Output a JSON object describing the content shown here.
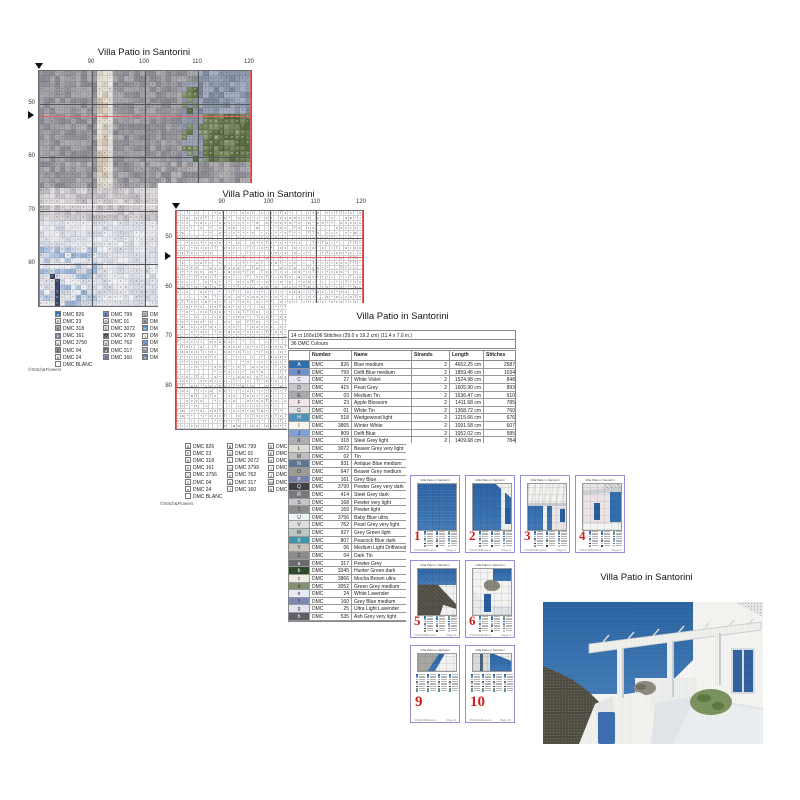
{
  "colors": {
    "accent_red": "#cc1f1f",
    "thumb_border": "#9191d9",
    "red_line": "#e06060",
    "sea": "#336fae"
  },
  "chart1": {
    "title": "Villa Patio in Santorini",
    "x_labels": [
      "90",
      "100",
      "110",
      "120"
    ],
    "y_labels": [
      "50",
      "60",
      "70",
      "80"
    ],
    "watermark": "©Stitch&Flowers",
    "legend": {
      "col1": [
        {
          "sym": "A",
          "num": "DMC 826",
          "color": "#2f6fad"
        },
        {
          "sym": "F",
          "num": "DMC 23",
          "color": "#f2e4ea"
        },
        {
          "sym": "K",
          "num": "DMC 318",
          "color": "#aeaeb2"
        },
        {
          "sym": "P",
          "num": "DMC 161",
          "color": "#7680a8"
        },
        {
          "sym": "U",
          "num": "DMC 3756",
          "color": "#eef5f9"
        },
        {
          "sym": "Z",
          "num": "DMC 04",
          "color": "#8b8b8b"
        },
        {
          "sym": "e",
          "num": "DMC 24",
          "color": "#e7e9f4"
        },
        {
          "sym": "·",
          "num": "DMC BLANC",
          "color": "#ffffff"
        }
      ],
      "col2": [
        {
          "sym": "B",
          "num": "DMC 799",
          "color": "#7291cc"
        },
        {
          "sym": "G",
          "num": "DMC 01",
          "color": "#e4e4e7"
        },
        {
          "sym": "L",
          "num": "DMC 3072",
          "color": "#dcdbd4"
        },
        {
          "sym": "Q",
          "num": "DMC 3799",
          "color": "#3f3f44"
        },
        {
          "sym": "V",
          "num": "DMC 762",
          "color": "#dfdfe2"
        },
        {
          "sym": "a",
          "num": "DMC 317",
          "color": "#69696e"
        },
        {
          "sym": "f",
          "num": "DMC 160",
          "color": "#7d89b4"
        }
      ],
      "col3": [
        {
          "sym": "D",
          "num": "DMC",
          "color": "#c6c7cb"
        },
        {
          "sym": "E",
          "num": "DMC",
          "color": "#a9a9ad"
        },
        {
          "sym": "H",
          "num": "DMC",
          "color": "#4f93ba"
        },
        {
          "sym": "I",
          "num": "DMC",
          "color": "#f8f6ef"
        },
        {
          "sym": "J",
          "num": "DMC",
          "color": "#7fa1d7"
        },
        {
          "sym": "M",
          "num": "DMC",
          "color": "#bfbfc2"
        },
        {
          "sym": "N",
          "num": "DMC",
          "color": "#5d7792"
        }
      ]
    }
  },
  "chart2": {
    "title": "Villa Patio in Santorini",
    "x_labels": [
      "90",
      "100",
      "110",
      "120"
    ],
    "y_labels": [
      "50",
      "60",
      "70",
      "80"
    ],
    "watermark": "©Stitch&Flowers"
  },
  "table": {
    "title": "Villa Patio in Santorini",
    "size_line": "14 ct 160x106 Stitches (29.0 x 19.2 cm) (11.4 x 7.6 in.)",
    "colors_line": "36 DMC Colours",
    "brand": "DMC",
    "headers": [
      "Number",
      "Name",
      "Strands",
      "Length",
      "Stitches"
    ],
    "rows": [
      {
        "sym": "A",
        "color": "#2f6fad",
        "code": "826",
        "name": "Blue medium",
        "strands": "2",
        "length": "4652.25 cm",
        "stitches": "2587"
      },
      {
        "sym": "B",
        "color": "#7291cc",
        "code": "799",
        "name": "Delft Blue medium",
        "strands": "2",
        "length": "1859.46 cm",
        "stitches": "1034"
      },
      {
        "sym": "C",
        "color": "#e8e8f2",
        "code": "27",
        "name": "White Violet",
        "strands": "2",
        "length": "1524.98 cm",
        "stitches": "848"
      },
      {
        "sym": "D",
        "color": "#c6c7cb",
        "code": "415",
        "name": "Pearl Grey",
        "strands": "2",
        "length": "1605.90 cm",
        "stitches": "893"
      },
      {
        "sym": "E",
        "color": "#a9a9ad",
        "code": "03",
        "name": "Medium Tin",
        "strands": "2",
        "length": "1636.47 cm",
        "stitches": "910"
      },
      {
        "sym": "F",
        "color": "#f2e4ea",
        "code": "23",
        "name": "Apple Blossom",
        "strands": "2",
        "length": "1411.68 cm",
        "stitches": "785"
      },
      {
        "sym": "G",
        "color": "#e4e4e7",
        "code": "01",
        "name": "White Tin",
        "strands": "2",
        "length": "1368.72 cm",
        "stitches": "760"
      },
      {
        "sym": "H",
        "color": "#4f93ba",
        "code": "518",
        "name": "Wedgewood light",
        "strands": "2",
        "length": "1215.66 cm",
        "stitches": "676"
      },
      {
        "sym": "I",
        "color": "#f8f6ef",
        "code": "3865",
        "name": "Winter White",
        "strands": "2",
        "length": "1091.58 cm",
        "stitches": "607"
      },
      {
        "sym": "J",
        "color": "#7fa1d7",
        "code": "809",
        "name": "Delft Blue",
        "strands": "2",
        "length": "1052.02 cm",
        "stitches": "585"
      },
      {
        "sym": "K",
        "color": "#aeaeb2",
        "code": "318",
        "name": "Steel Grey light",
        "strands": "2",
        "length": "1409.68 cm",
        "stitches": "784"
      },
      {
        "sym": "L",
        "color": "#dcdbd4",
        "code": "3072",
        "name": "Beaver Grey very light",
        "strands": "",
        "length": "",
        "stitches": ""
      },
      {
        "sym": "M",
        "color": "#bfbfc2",
        "code": "02",
        "name": "Tin",
        "strands": "",
        "length": "",
        "stitches": ""
      },
      {
        "sym": "N",
        "color": "#5d7792",
        "code": "931",
        "name": "Antique Blue medium",
        "strands": "",
        "length": "",
        "stitches": ""
      },
      {
        "sym": "O",
        "color": "#9c9c93",
        "code": "647",
        "name": "Beaver Grey medium",
        "strands": "",
        "length": "",
        "stitches": ""
      },
      {
        "sym": "P",
        "color": "#7680a8",
        "code": "161",
        "name": "Grey Blue",
        "strands": "",
        "length": "",
        "stitches": ""
      },
      {
        "sym": "Q",
        "color": "#3f3f44",
        "code": "3799",
        "name": "Pewter Grey very dark",
        "strands": "",
        "length": "",
        "stitches": ""
      },
      {
        "sym": "R",
        "color": "#77777c",
        "code": "414",
        "name": "Steel Grey dark",
        "strands": "",
        "length": "",
        "stitches": ""
      },
      {
        "sym": "S",
        "color": "#c6c7ca",
        "code": "168",
        "name": "Pewter very light",
        "strands": "",
        "length": "",
        "stitches": ""
      },
      {
        "sym": "T",
        "color": "#8d8d90",
        "code": "169",
        "name": "Pewter light",
        "strands": "",
        "length": "",
        "stitches": ""
      },
      {
        "sym": "U",
        "color": "#eef5f9",
        "code": "3756",
        "name": "Baby Blue ultra",
        "strands": "",
        "length": "",
        "stitches": ""
      },
      {
        "sym": "V",
        "color": "#dfdfe2",
        "code": "762",
        "name": "Pearl Grey very light",
        "strands": "",
        "length": "",
        "stitches": ""
      },
      {
        "sym": "W",
        "color": "#bac9c5",
        "code": "927",
        "name": "Grey Green light",
        "strands": "",
        "length": "",
        "stitches": ""
      },
      {
        "sym": "X",
        "color": "#3f93ab",
        "code": "807",
        "name": "Peacock Blue dark",
        "strands": "",
        "length": "",
        "stitches": ""
      },
      {
        "sym": "Y",
        "color": "#c9c2b6",
        "code": "06",
        "name": "Medium Light Driftwood",
        "strands": "",
        "length": "",
        "stitches": ""
      },
      {
        "sym": "Z",
        "color": "#8b8b8b",
        "code": "04",
        "name": "Dark Tin",
        "strands": "",
        "length": "",
        "stitches": ""
      },
      {
        "sym": "a",
        "color": "#69696e",
        "code": "317",
        "name": "Pewter Grey",
        "strands": "",
        "length": "",
        "stitches": ""
      },
      {
        "sym": "b",
        "color": "#2c4a2a",
        "code": "3345",
        "name": "Hunter Green dark",
        "strands": "",
        "length": "",
        "stitches": ""
      },
      {
        "sym": "c",
        "color": "#f0ebe1",
        "code": "3866",
        "name": "Mocha Brown ultra",
        "strands": "",
        "length": "",
        "stitches": ""
      },
      {
        "sym": "d",
        "color": "#84926f",
        "code": "3052",
        "name": "Green Grey medium",
        "strands": "",
        "length": "",
        "stitches": ""
      },
      {
        "sym": "e",
        "color": "#e7e9f4",
        "code": "24",
        "name": "White Lavender",
        "strands": "",
        "length": "",
        "stitches": ""
      },
      {
        "sym": "f",
        "color": "#7d89b4",
        "code": "160",
        "name": "Grey Blue medium",
        "strands": "",
        "length": "",
        "stitches": ""
      },
      {
        "sym": "g",
        "color": "#e4e4f0",
        "code": "25",
        "name": "Ultra Light Lavender",
        "strands": "",
        "length": "",
        "stitches": ""
      },
      {
        "sym": "h",
        "color": "#5f5f66",
        "code": "535",
        "name": "Ash Grey very light",
        "strands": "",
        "length": "",
        "stitches": ""
      }
    ]
  },
  "thumbnails": {
    "page_word": "Page",
    "watermark": "©Stitch&Flowers",
    "mini_title": "Villa Patio in Santorini",
    "pages": [
      {
        "num": "1",
        "scene": "sea",
        "row": 0,
        "col": 0
      },
      {
        "num": "2",
        "scene": "sea-pergola",
        "row": 0,
        "col": 1
      },
      {
        "num": "3",
        "scene": "pergola-roof",
        "row": 0,
        "col": 2
      },
      {
        "num": "4",
        "scene": "wall-windows",
        "row": 0,
        "col": 3
      },
      {
        "num": "5",
        "scene": "cliff",
        "row": 1,
        "col": 0
      },
      {
        "num": "6",
        "scene": "building-door",
        "row": 1,
        "col": 1
      },
      {
        "num": "9",
        "scene": "strip-cliff",
        "row": 2,
        "col": 0
      },
      {
        "num": "10",
        "scene": "strip-building",
        "row": 2,
        "col": 1
      }
    ]
  },
  "image_window": {
    "title": "Villa Patio in Santorini"
  }
}
